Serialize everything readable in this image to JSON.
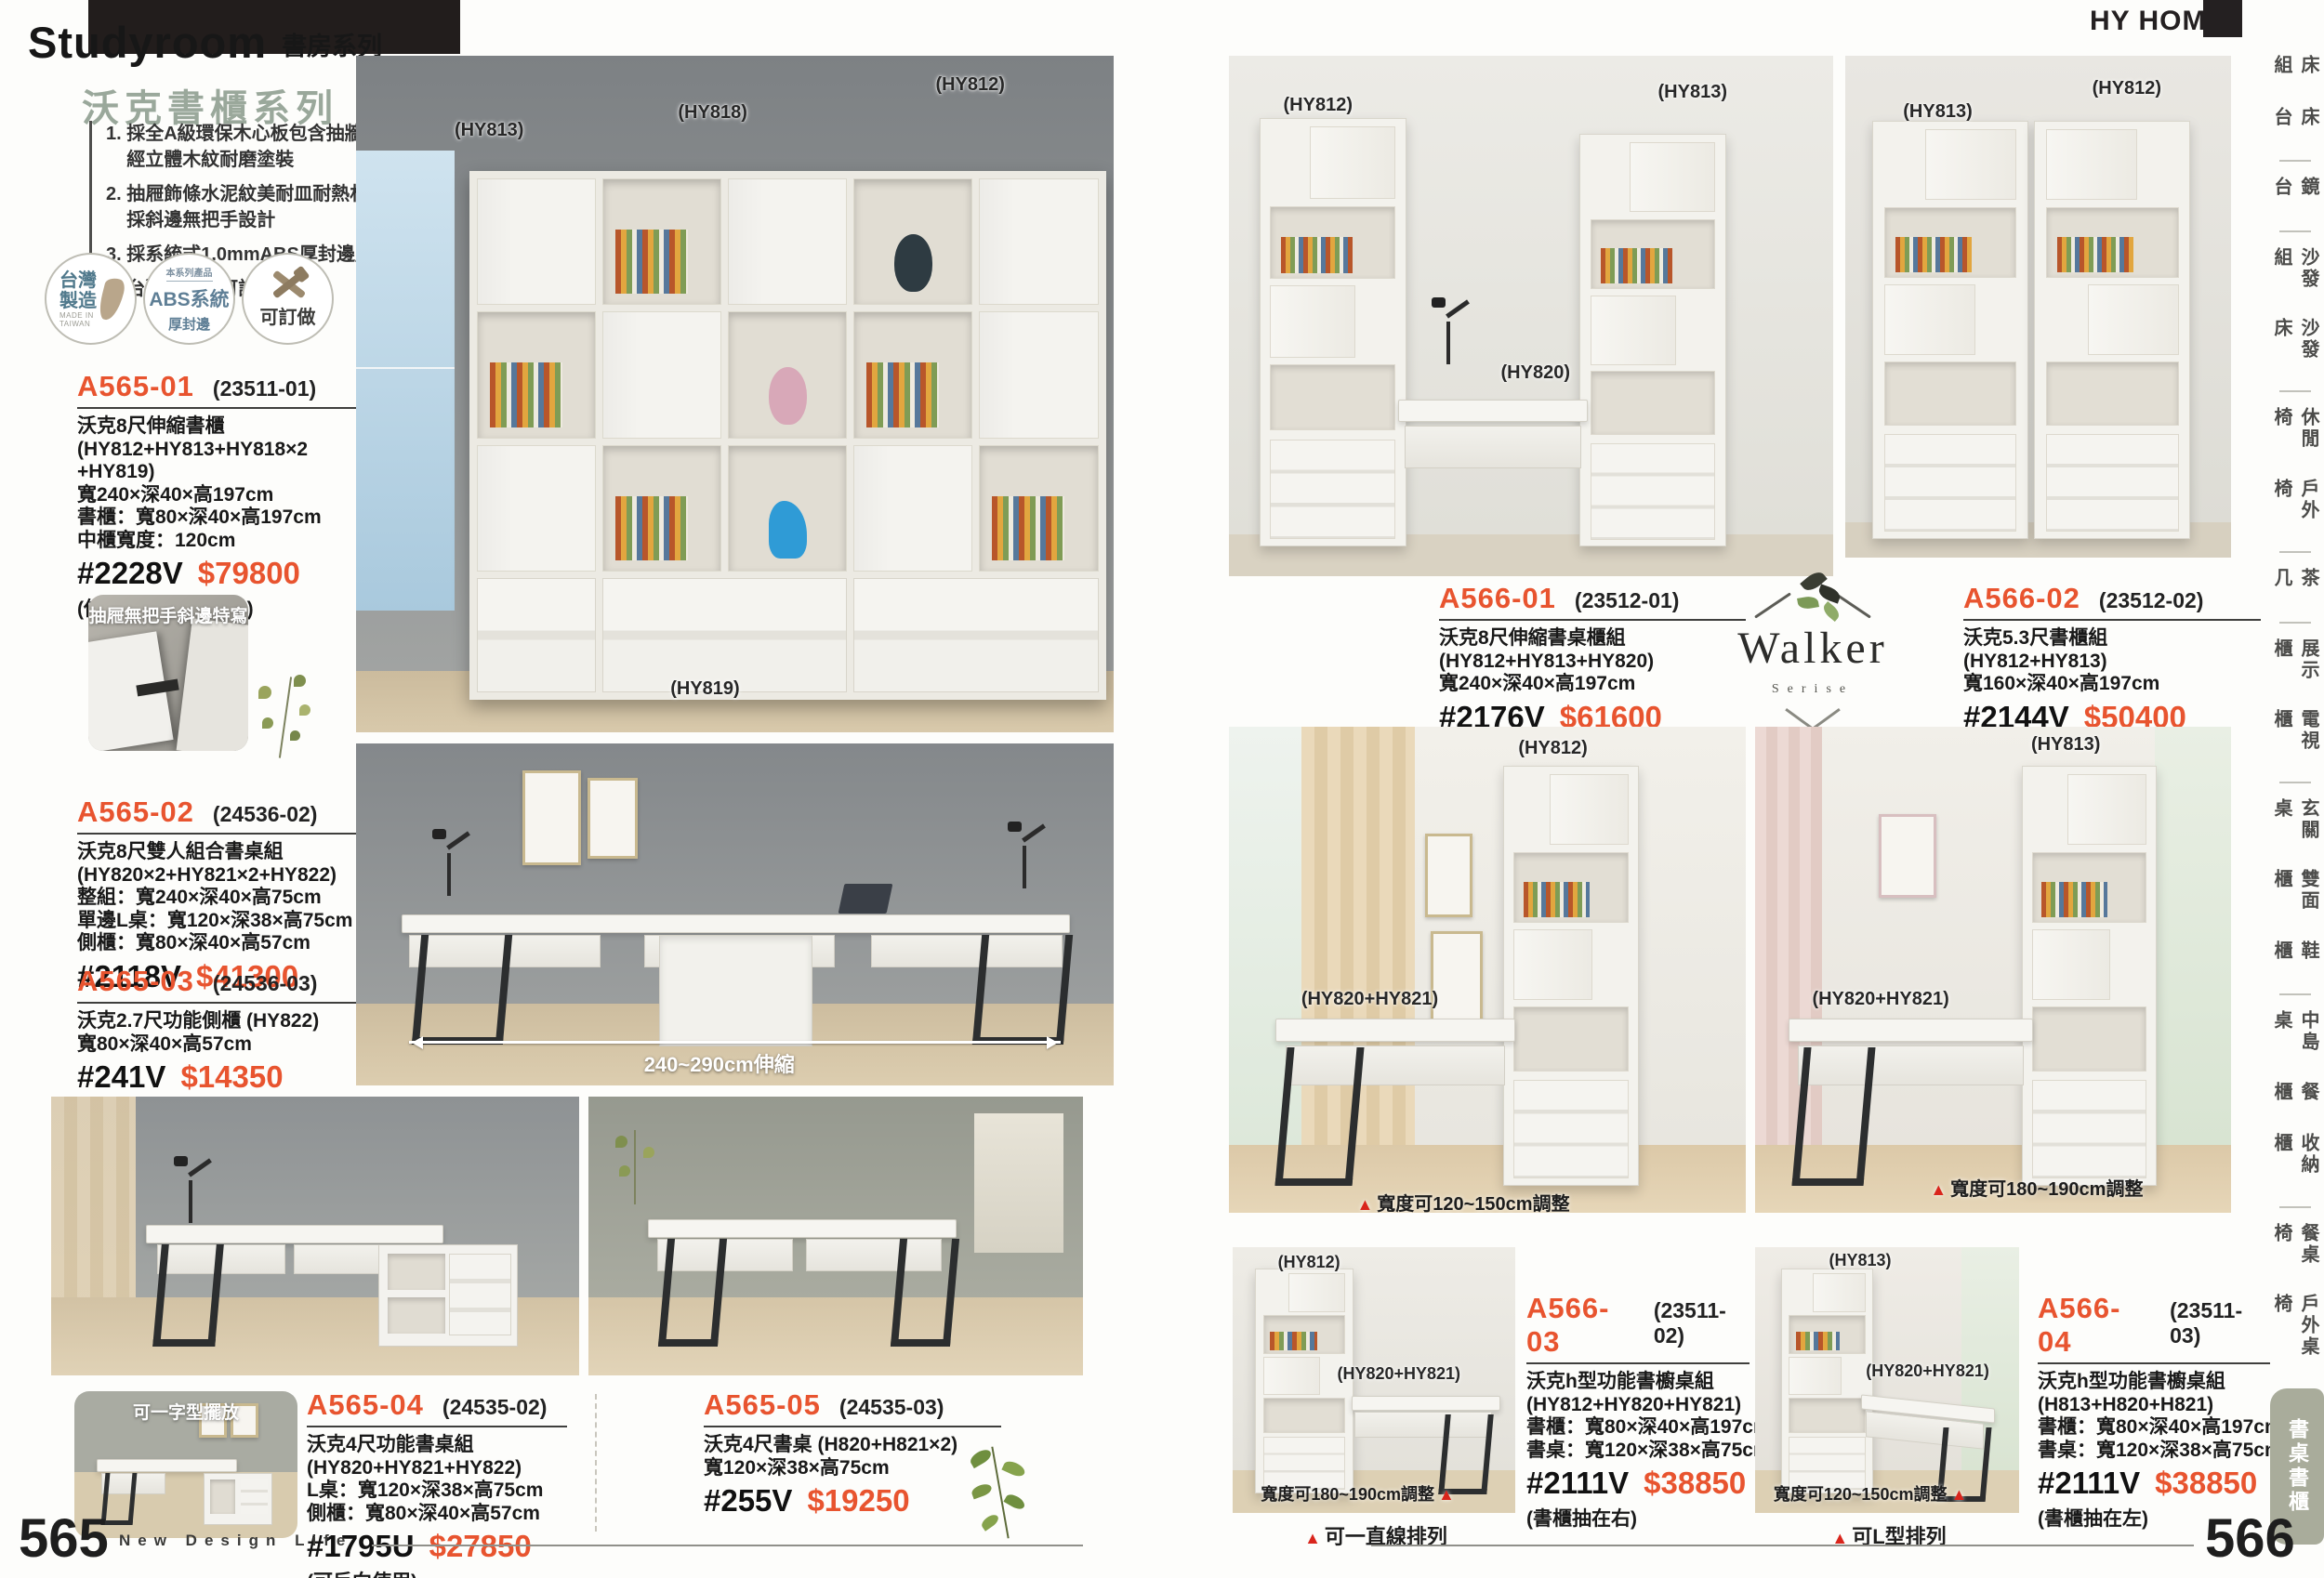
{
  "brand": {
    "name": "HY HOME"
  },
  "header": {
    "title_en": "Studyroom",
    "title_zh": "書房系列"
  },
  "series": {
    "title": "沃克書櫃系列",
    "features": [
      "1. 採全A級環保木心板包含抽牆，\n    經立體木紋耐磨塗裝",
      "2. 抽屜飾條水泥紋美耐皿耐熱材質，\n    採斜邊無把手設計",
      "3. 採系統式1.0mmABS厚封邊處理",
      "4. 台灣製造，可訂製"
    ]
  },
  "badges": {
    "taiwan": {
      "line1": "台灣",
      "line2": "製造",
      "sub1": "MADE IN",
      "sub2": "TAIWAN"
    },
    "abs": {
      "top": "本系列產品",
      "main": "ABS系統",
      "sub": "厚封邊"
    },
    "custom": {
      "label": "可訂做"
    }
  },
  "products": {
    "a565_01": {
      "id": "A565-01",
      "code": "(23511-01)",
      "lines": "沃克8尺伸縮書櫃\n(HY812+HY813+HY818×2\n+HY819)\n寬240×深40×高197cm\n書櫃：寬80×深40×高197cm\n中櫃寬度：120cm",
      "sku": "#2228V",
      "price": "$79800",
      "note": "(伸縮：240~260cm)"
    },
    "a565_02": {
      "id": "A565-02",
      "code": "(24536-02)",
      "lines": "沃克8尺雙人組合書桌組\n(HY820×2+HY821×2+HY822)\n整組：寬240×深40×高75cm\n單邊L桌：寬120×深38×高75cm\n側櫃：寬80×深40×高57cm",
      "sku": "#2118V",
      "price": "$41300",
      "note": ""
    },
    "a565_03": {
      "id": "A565-03",
      "code": "(24536-03)",
      "lines": "沃克2.7尺功能側櫃 (HY822)\n寬80×深40×高57cm",
      "sku": "#241V",
      "price": "$14350",
      "note": ""
    },
    "a565_04": {
      "id": "A565-04",
      "code": "(24535-02)",
      "lines": "沃克4尺功能書桌組\n(HY820+HY821+HY822)\nL桌：寬120×深38×高75cm\n側櫃：寬80×深40×高57cm",
      "sku": "#1795U",
      "price": "$27850",
      "note": "(可反向使用)"
    },
    "a565_05": {
      "id": "A565-05",
      "code": "(24535-03)",
      "lines": "沃克4尺書桌 (H820+H821×2)\n寬120×深38×高75cm",
      "sku": "#255V",
      "price": "$19250",
      "note": ""
    },
    "a566_01": {
      "id": "A566-01",
      "code": "(23512-01)",
      "lines": "沃克8尺伸縮書桌櫃組\n(HY812+HY813+HY820)\n寬240×深40×高197cm",
      "sku": "#2176V",
      "price": "$61600",
      "note": "(伸縮：240~260cm)"
    },
    "a566_02": {
      "id": "A566-02",
      "code": "(23512-02)",
      "lines": "沃克5.3尺書櫃組\n(HY812+HY813)\n寬160×深40×高197cm",
      "sku": "#2144V",
      "price": "$50400",
      "note": ""
    },
    "a566_03": {
      "id": "A566-03",
      "code": "(23511-02)",
      "lines": "沃克h型功能書櫥桌組\n(HY812+HY820+HY821)\n書櫃：寬80×深40×高197cm\n書桌：寬120×深38×高75cm",
      "sku": "#2111V",
      "price": "$38850",
      "note": "(書櫃抽在右)"
    },
    "a566_04": {
      "id": "A566-04",
      "code": "(23511-03)",
      "lines": "沃克h型功能書櫥桌組\n(H813+H820+H821)\n書櫃：寬80×深40×高197cm\n書桌：寬120×深38×高75cm",
      "sku": "#2111V",
      "price": "$38850",
      "note": "(書櫃抽在左)"
    }
  },
  "photos": {
    "main": {
      "l1": "(HY813)",
      "l2": "(HY818)",
      "l3": "(HY812)",
      "l4": "(HY819)"
    },
    "desk": {
      "dim": "240~290cm伸縮"
    },
    "detail": {
      "caption": "抽屜無把手斜邊特寫"
    },
    "inline": {
      "caption": "可一字型擺放"
    },
    "rt1": {
      "l1": "(HY812)",
      "l2": "(HY813)",
      "l3": "(HY820)"
    },
    "rt2": {
      "l1": "(HY813)",
      "l2": "(HY812)"
    },
    "rm1": {
      "l1": "(HY812)",
      "l2": "(HY820+HY821)",
      "tri": "▲",
      "cap": "寬度可120~150cm調整"
    },
    "rm2": {
      "l1": "(HY813)",
      "l2": "(HY820+HY821)",
      "tri": "▲",
      "cap": "寬度可180~190cm調整"
    },
    "rb1": {
      "l1": "(HY812)",
      "l2": "(HY820+HY821)",
      "cap": "寬度可180~190cm調整",
      "tri": "▲",
      "sub_tri": "▲",
      "sub": "可一直線排列"
    },
    "rb2": {
      "l1": "(HY813)",
      "l2": "(HY820+HY821)",
      "cap": "寬度可120~150cm調整",
      "tri": "▲",
      "sub_tri": "▲",
      "sub": "可L型排列"
    }
  },
  "walker": {
    "name": "Walker",
    "sub": "Serise"
  },
  "sidebar": {
    "items": [
      "床組",
      "床台",
      "鏡台",
      "沙發組",
      "沙發床",
      "休閒椅",
      "戶外椅",
      "茶几",
      "展示櫃",
      "電視櫃",
      "玄關桌",
      "雙面櫃",
      "鞋櫃",
      "中島桌",
      "餐櫃",
      "收納櫃",
      "餐桌椅",
      "戶外桌椅",
      "書桌書櫃"
    ]
  },
  "footer": {
    "left_num": "565",
    "tagline": "New Design Life",
    "right_num": "566"
  },
  "colors": {
    "accent": "#e8542f",
    "sage": "#9aa89b",
    "sidebar_badge": "#a9ac9b"
  }
}
